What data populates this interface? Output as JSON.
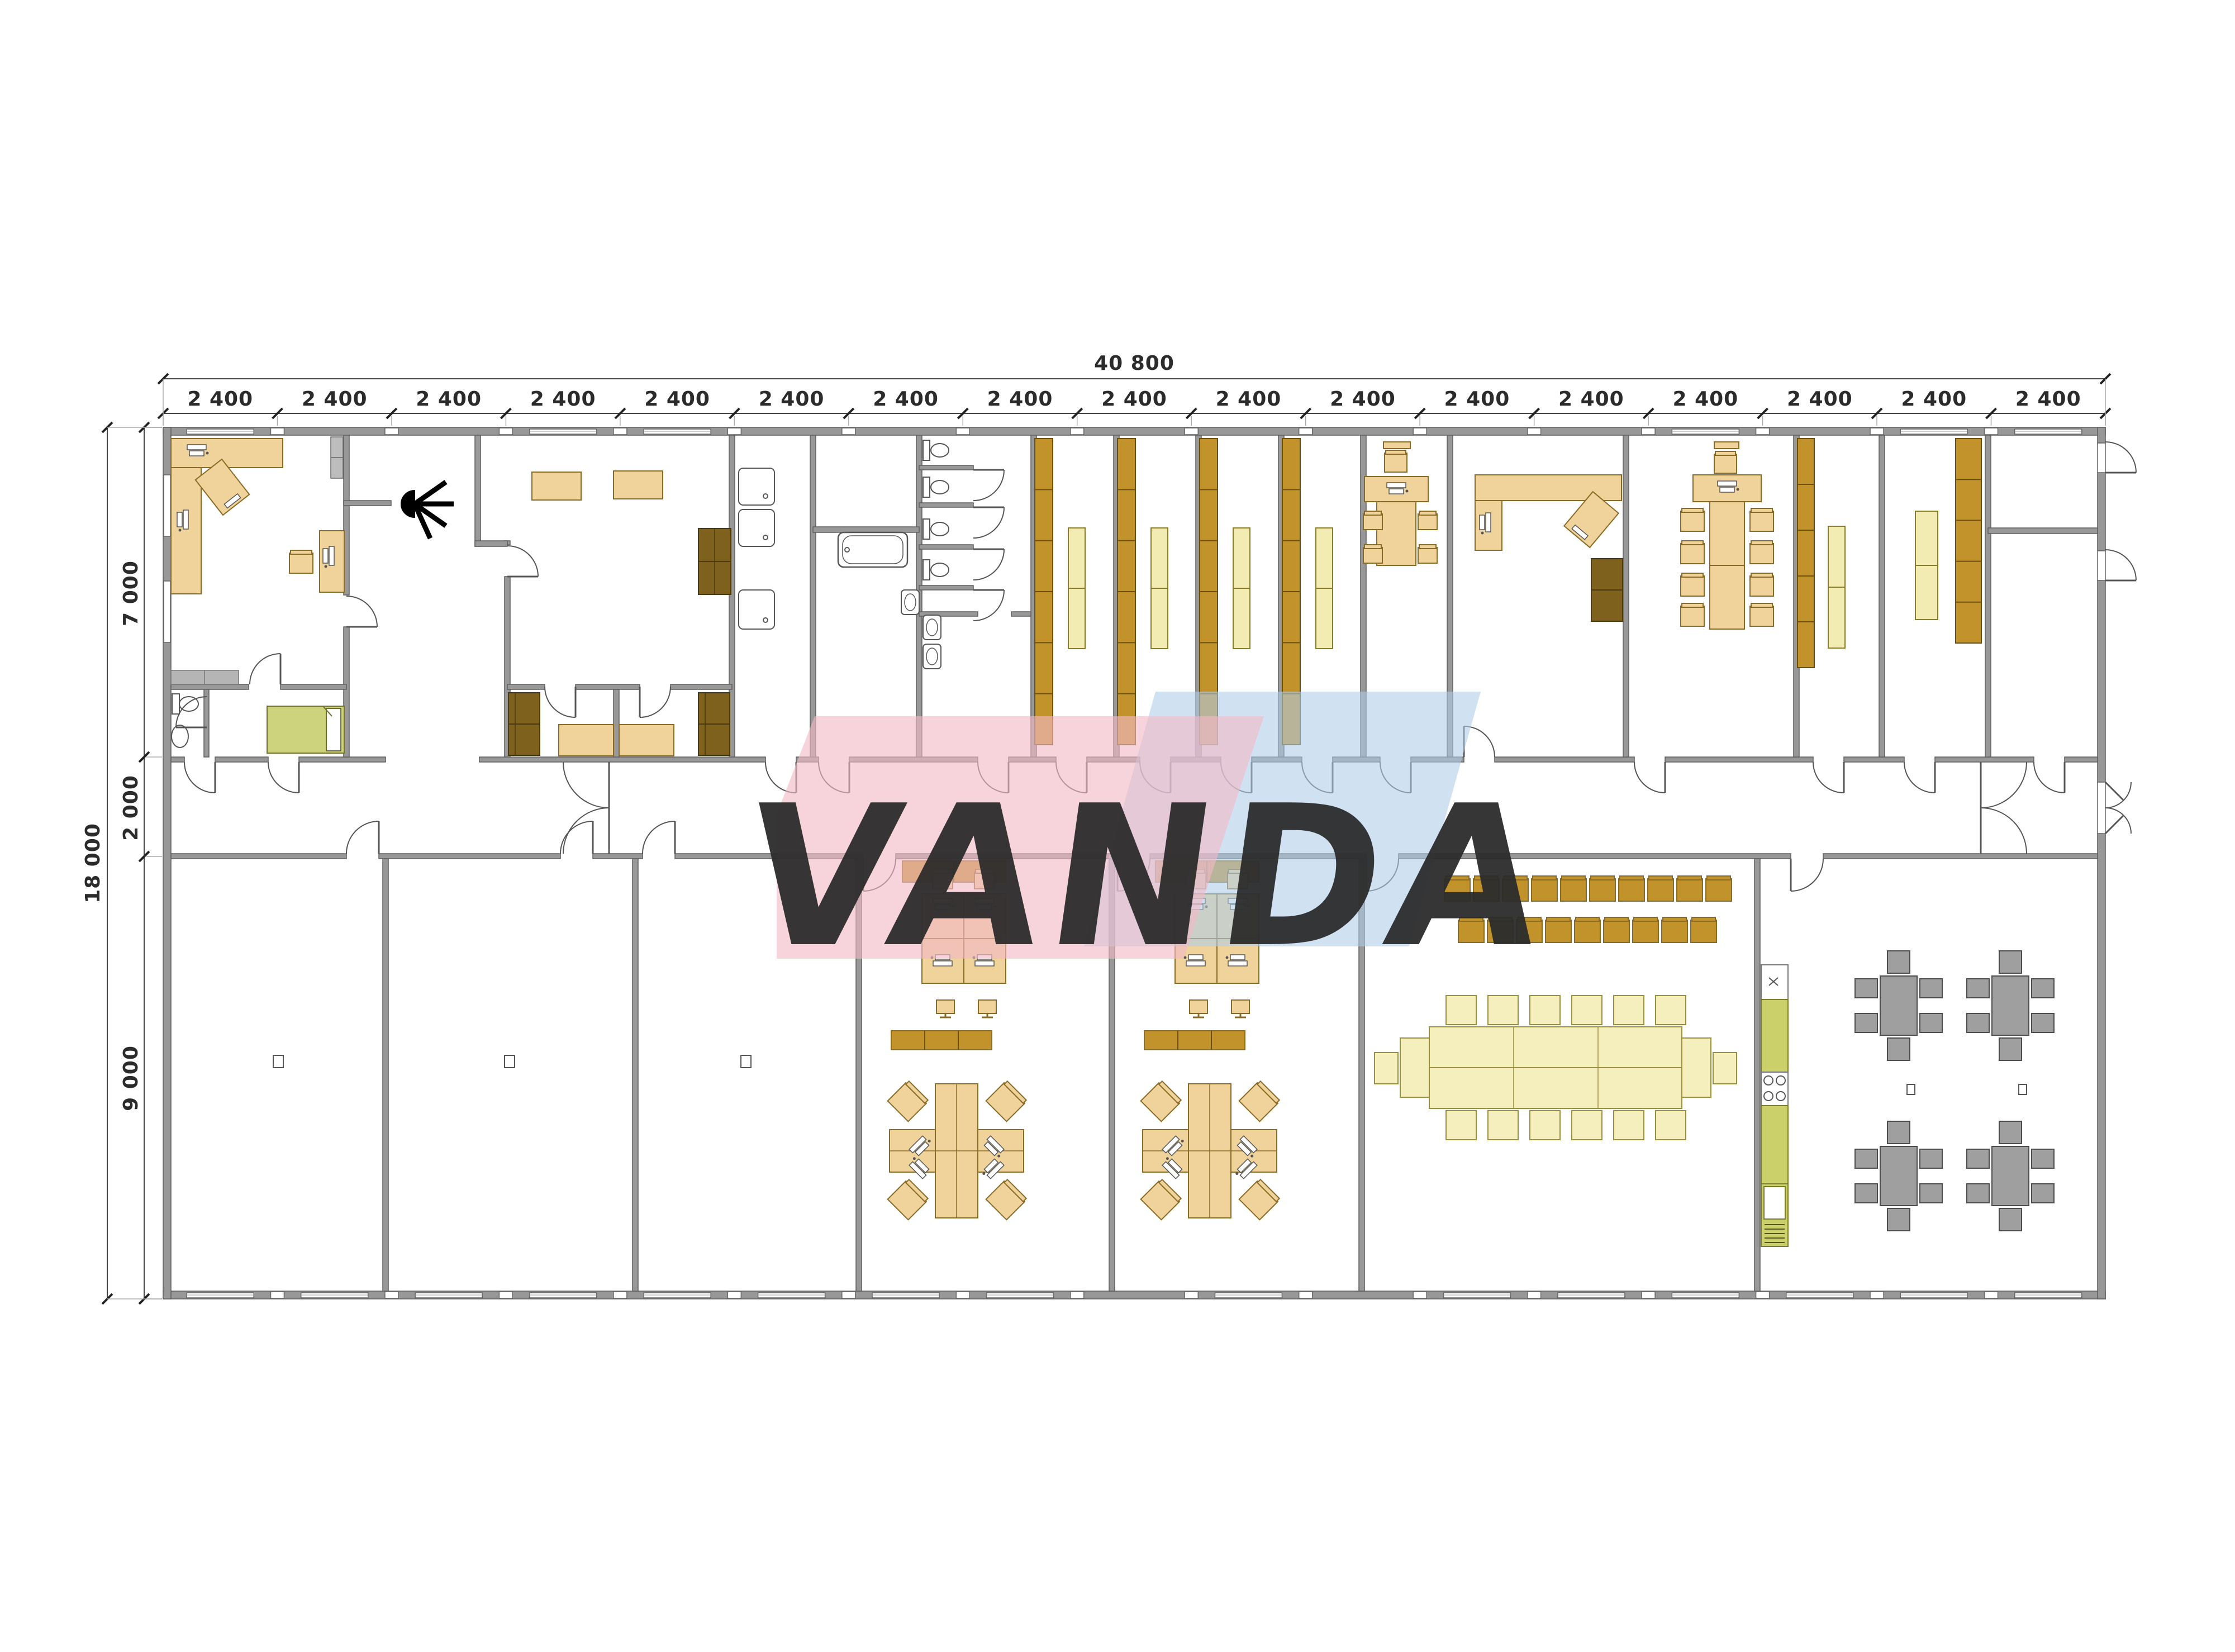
{
  "drawing": {
    "top_dimension_total": "40 800",
    "top_dimension_segments": [
      "2 400",
      "2 400",
      "2 400",
      "2 400",
      "2 400",
      "2 400",
      "2 400",
      "2 400",
      "2 400",
      "2 400",
      "2 400",
      "2 400",
      "2 400",
      "2 400",
      "2 400",
      "2 400",
      "2 400"
    ],
    "left_dimension_total": "18 000",
    "left_dimension_segments": [
      "7 000",
      "2 000",
      "9 000"
    ],
    "watermark_text": "VANDA"
  },
  "colors": {
    "wall": "#989898",
    "wall_stroke": "#5f5f5f",
    "wood": "#f0d39b",
    "wood_stroke": "#8a6b25",
    "shelf": "#c3932b",
    "shelf_stroke": "#6b4f0d",
    "dark_wood": "#7d611c",
    "pale_table": "#f5efbe",
    "light_cabinet": "#f2ecb2",
    "bed_green": "#ccd37c",
    "kitchen_green": "#ccd06b",
    "gray_furniture": "#9f9f9f",
    "dim_text": "#2b2b2b",
    "watermark_pink": "#f2bac6",
    "watermark_blue": "#aecbe8"
  }
}
